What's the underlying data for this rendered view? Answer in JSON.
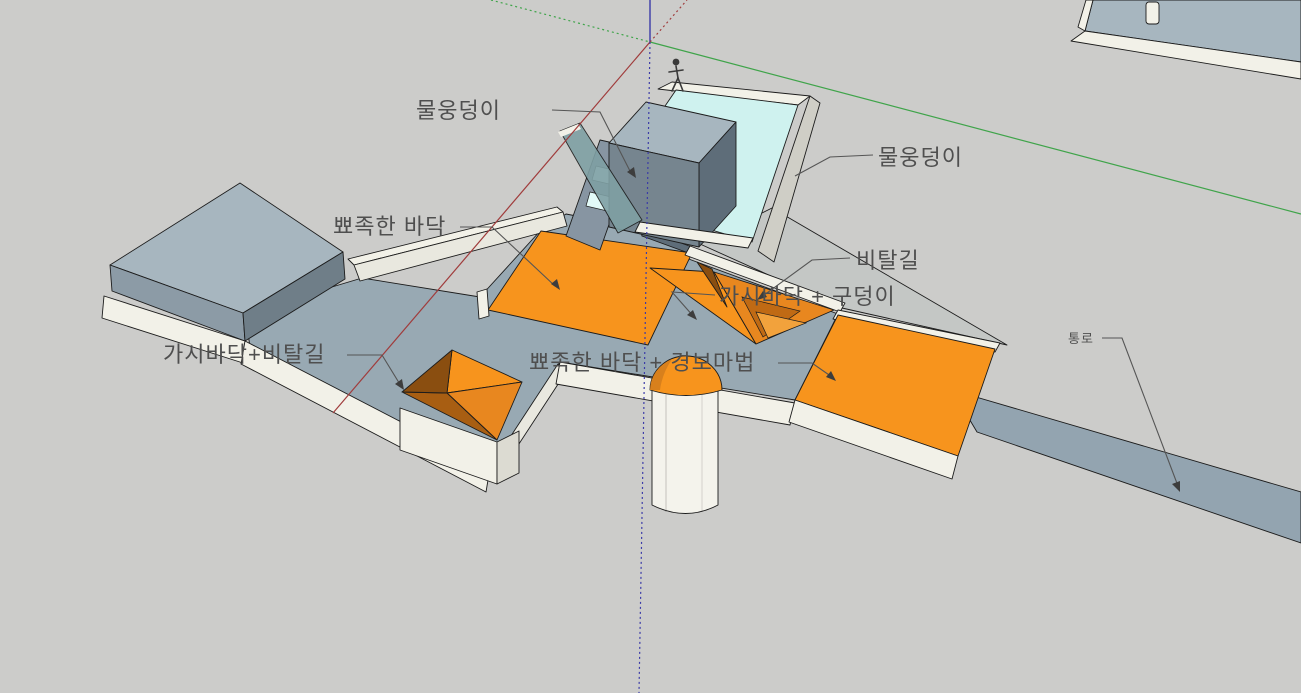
{
  "window": {
    "type": "3d-modeler-viewport",
    "background": "#CCCCCA"
  },
  "labels": {
    "water_pool_left": {
      "text": "물웅덩이"
    },
    "water_pool_right": {
      "text": "물웅덩이"
    },
    "spike_floor": {
      "text": "뾰족한 바닥"
    },
    "slope": {
      "text": "비탈길"
    },
    "spike_floor_pit": {
      "text": "가시바닥 + 구덩이"
    },
    "spike_floor_slope": {
      "text": "가시바닥+비탈길"
    },
    "spike_floor_alarm": {
      "text": "뾰족한 바닥 + 경보마법"
    },
    "passage": {
      "text": "통로"
    }
  },
  "colors": {
    "background": "#CCCCCA",
    "floor_gray": "#98A9B3",
    "platform_top_light": "#A7B6BF",
    "wall_medium": "#8C9BA6",
    "wall_dark": "#5E6D79",
    "box_side_dark": "#6F7E88",
    "ramp_gray": "#8795A2",
    "trim_white": "#F2F1E8",
    "trim_shadow": "#E9E8DF",
    "water_cyan": "#CFF2EF",
    "water_step_cyan": "#E2FAF8",
    "glass_teal": "#7FA0A4",
    "outer_wall_light": "#CFCEC6",
    "slope_gray": "#C4C7C5",
    "passage_gray": "#93A4B0",
    "orange_bright": "#F7941D",
    "orange_mid": "#E8871F",
    "orange_dark": "#C06A14",
    "orange_deep": "#8A4E10",
    "orange_shade": "#A85E12",
    "dome_shade": "#D8801C",
    "axis_red": "#A03C3C",
    "axis_green": "#3FA44A",
    "axis_blue": "#3B3BA8",
    "label_text": "#4F4F4F",
    "leader_line": "#555555"
  },
  "axes": {
    "x_axis": "red",
    "y_axis": "green",
    "z_axis": "blue",
    "origin_px": [
      650,
      42
    ],
    "negative_style": "dotted"
  },
  "scene_objects": [
    "water-pool-basin",
    "pool-inner-block",
    "pool-steps",
    "scale-figure",
    "west-platform",
    "west-box",
    "west-spike-pit",
    "center-spike-floor",
    "v-spike-pit",
    "alarm-dome-cylinder",
    "east-slope",
    "east-spike-floor",
    "passage-strip",
    "corner-platform-top-right"
  ]
}
